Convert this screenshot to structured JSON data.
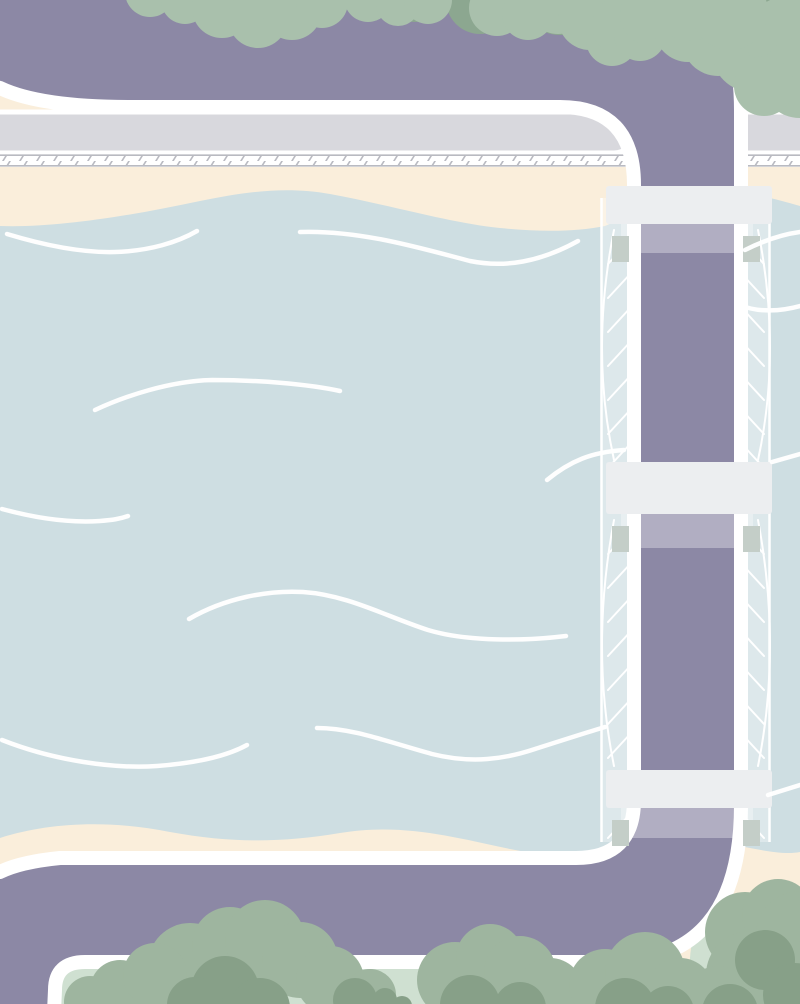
{
  "scene": {
    "title": "Top-down illustrated map of a river with a suspension bridge",
    "view": "top-down flat vector illustration",
    "features": [
      "river",
      "suspension-bridge",
      "ring-road",
      "riverside-road",
      "railroad-crossing",
      "sand-banks",
      "tree-lines",
      "grass-banks"
    ]
  },
  "palette": {
    "water": "#cedee2",
    "sand": "#faeedb",
    "grass": "#cfe0d1",
    "green_bank": "#d8e5db",
    "road_purple": "#8c88a5",
    "road_gray": "#d8d8dd",
    "bridge_deck": "#eceef0",
    "bridge_tab": "#c4cec8",
    "hatch_line": "#b9bac1",
    "tree_top_light": "#a9c0ac",
    "tree_top_dark": "#8ca790",
    "tree_bottom_light": "#9eb59f",
    "tree_bottom_dark": "#87a088",
    "wave_white": "#ffffff",
    "outline_white": "#ffffff"
  },
  "bridge": {
    "crossbar_count": 3,
    "cable_sides": 2
  },
  "water": {
    "wave_line_count": 12
  },
  "roads": {
    "purple_loop": 1,
    "gray_road": 1,
    "railroad_track": 1
  }
}
